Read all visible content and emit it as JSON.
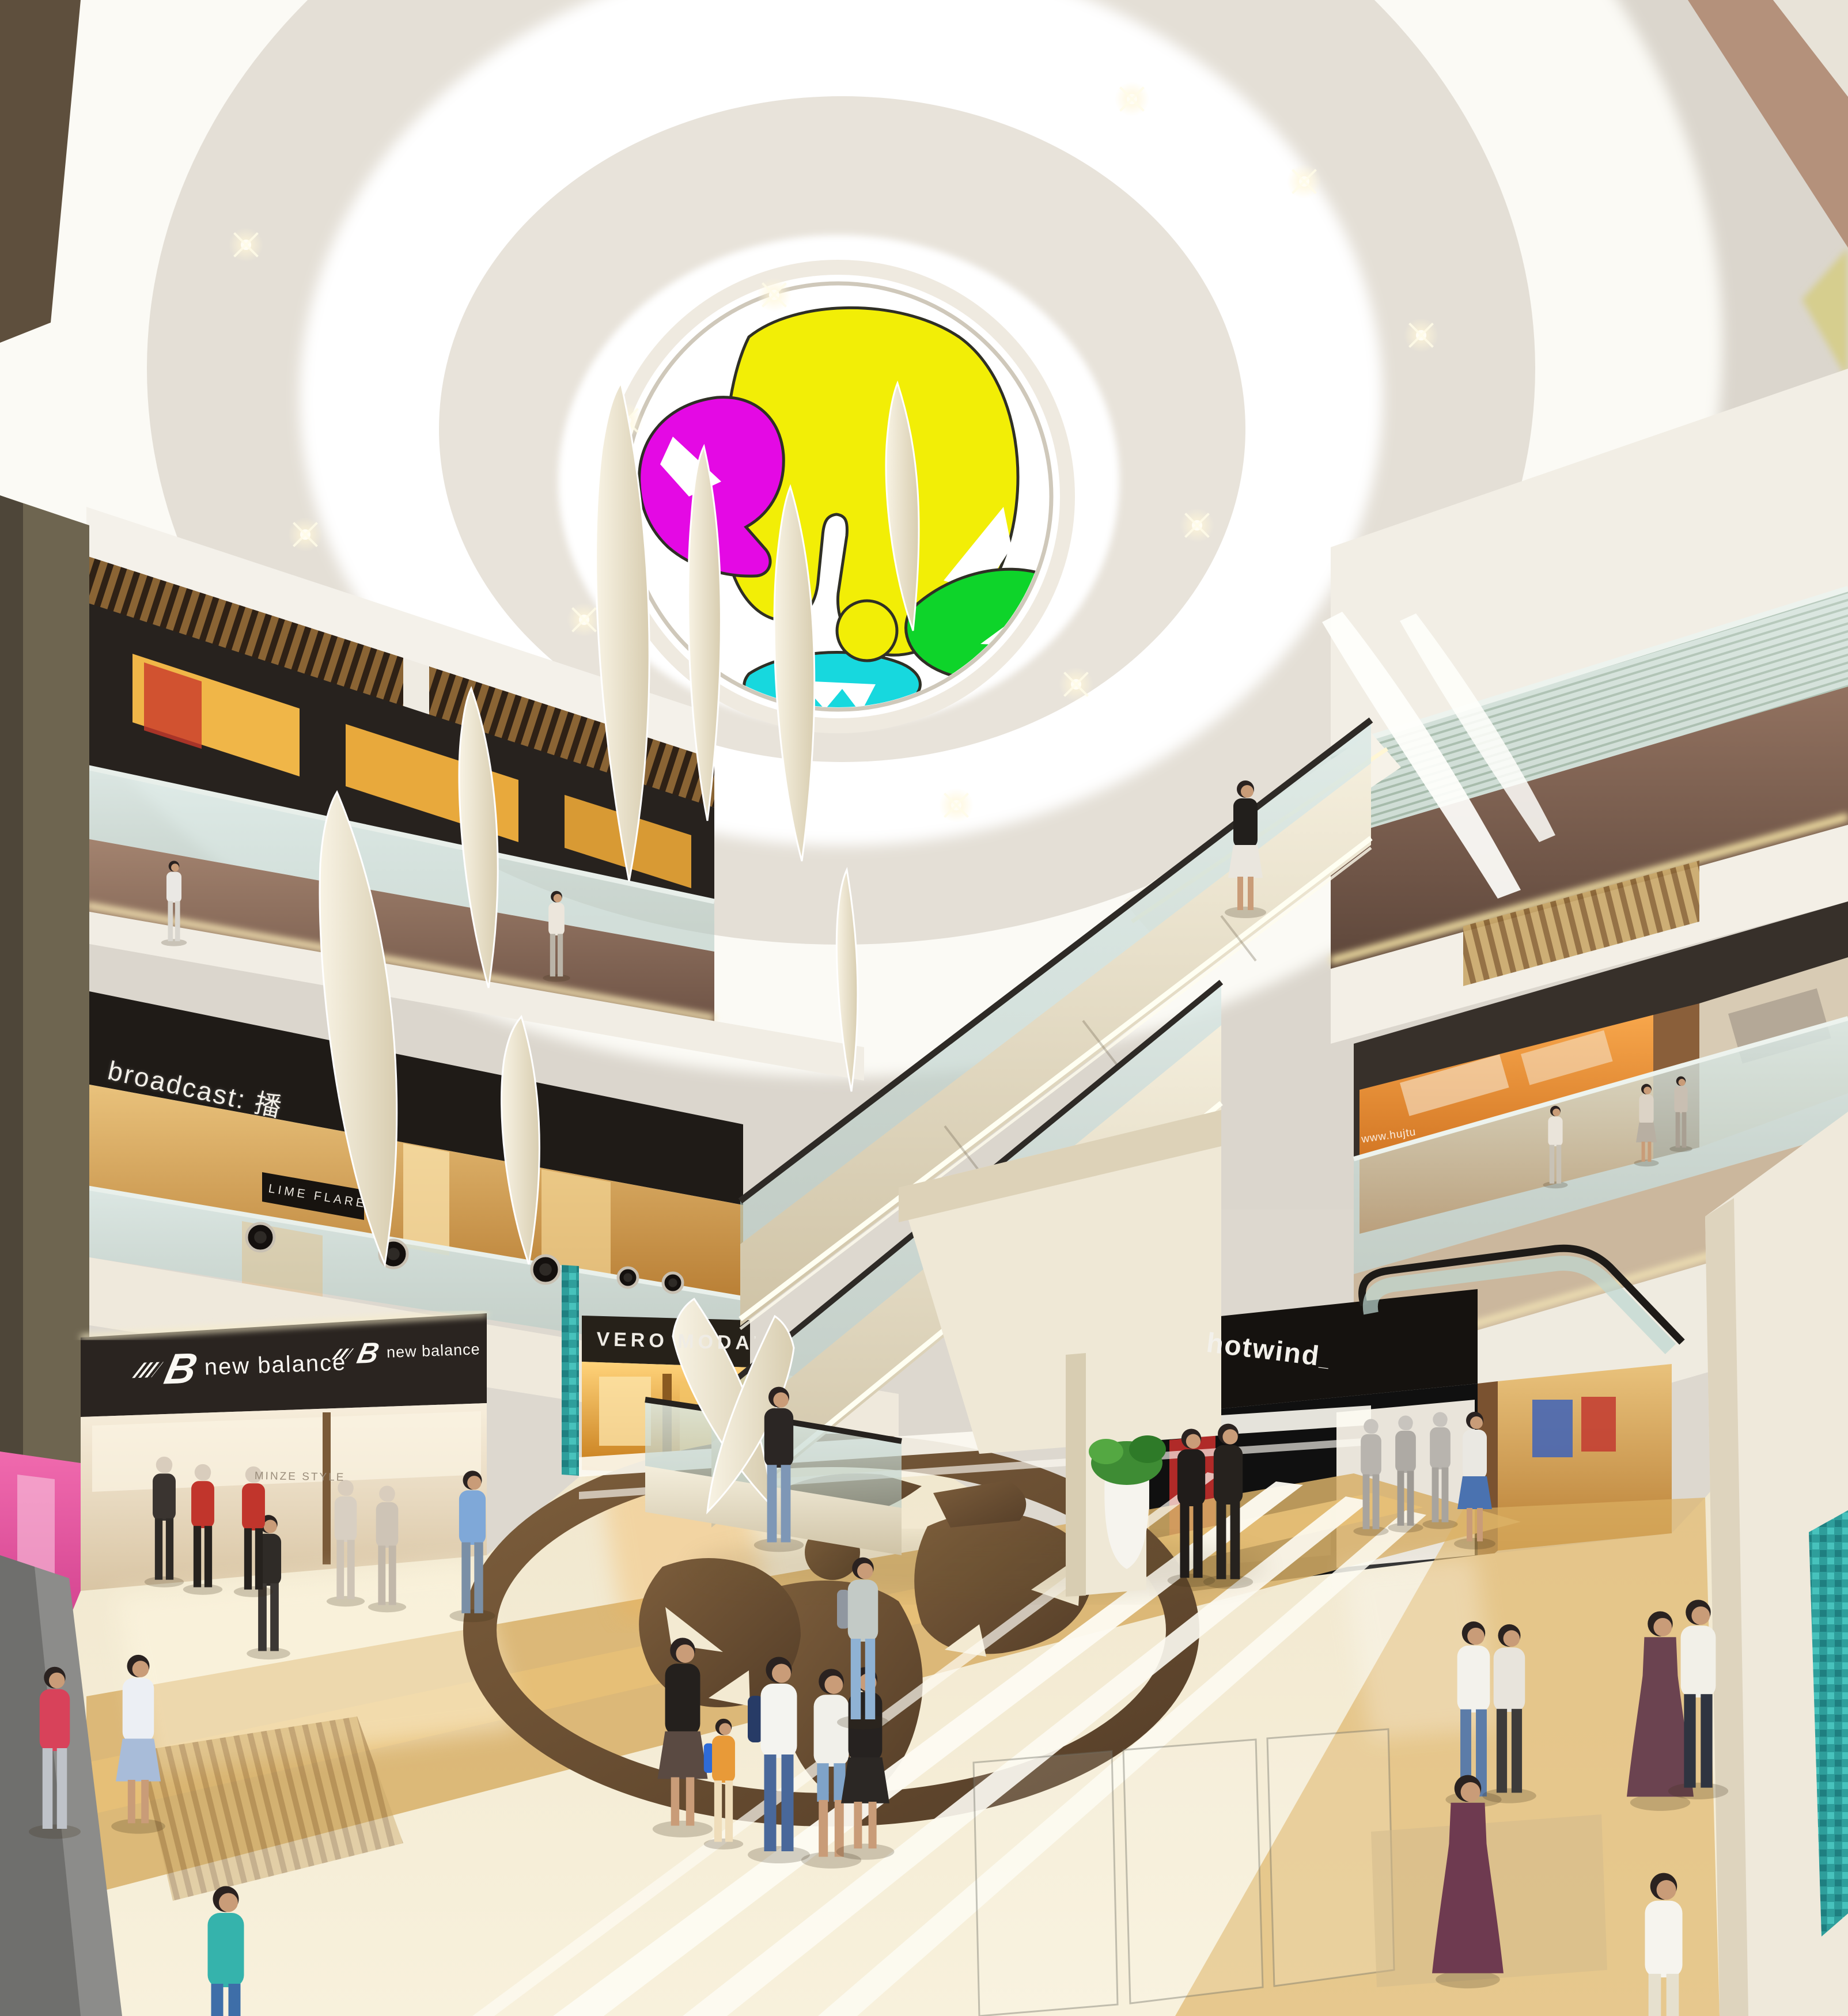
{
  "scene": {
    "description": "Shopping mall atrium interior rendering, three levels, escalators, circular stained-glass skylight",
    "levels_visible": 3
  },
  "signs": {
    "broadcast": {
      "label": "broadcast: 播"
    },
    "lime_flare": {
      "label": "LIME FLARE"
    },
    "new_balance_left": {
      "logo_glyph": "B",
      "label": "new balance"
    },
    "new_balance_right": {
      "logo_glyph": "B",
      "label": "new balance"
    },
    "minze_style": {
      "label": "MINZE STYLE"
    },
    "vero_moda": {
      "label": "VERO MODA",
      "mark": "’"
    },
    "hotwind": {
      "label": "hotwind",
      "mark": "_"
    },
    "web_banner": {
      "label": "www.hujtu"
    }
  },
  "colors": {
    "skylight_magenta": "#E409E4",
    "skylight_yellow": "#F2EE06",
    "skylight_green": "#0ED42A",
    "skylight_cyan": "#17D8DE",
    "ceiling_cream": "#E7E2D9",
    "fascia_brown": "#8E6F5D",
    "sign_fascia_black": "#201B17",
    "floor_beige": "#F2E9D2",
    "floor_gold_band": "#D7AF67",
    "floor_medallion_brown": "#6F5233",
    "glass_teal_mosaic": "#2E9E9B",
    "sculpture_cream": "#EFE7D2"
  }
}
